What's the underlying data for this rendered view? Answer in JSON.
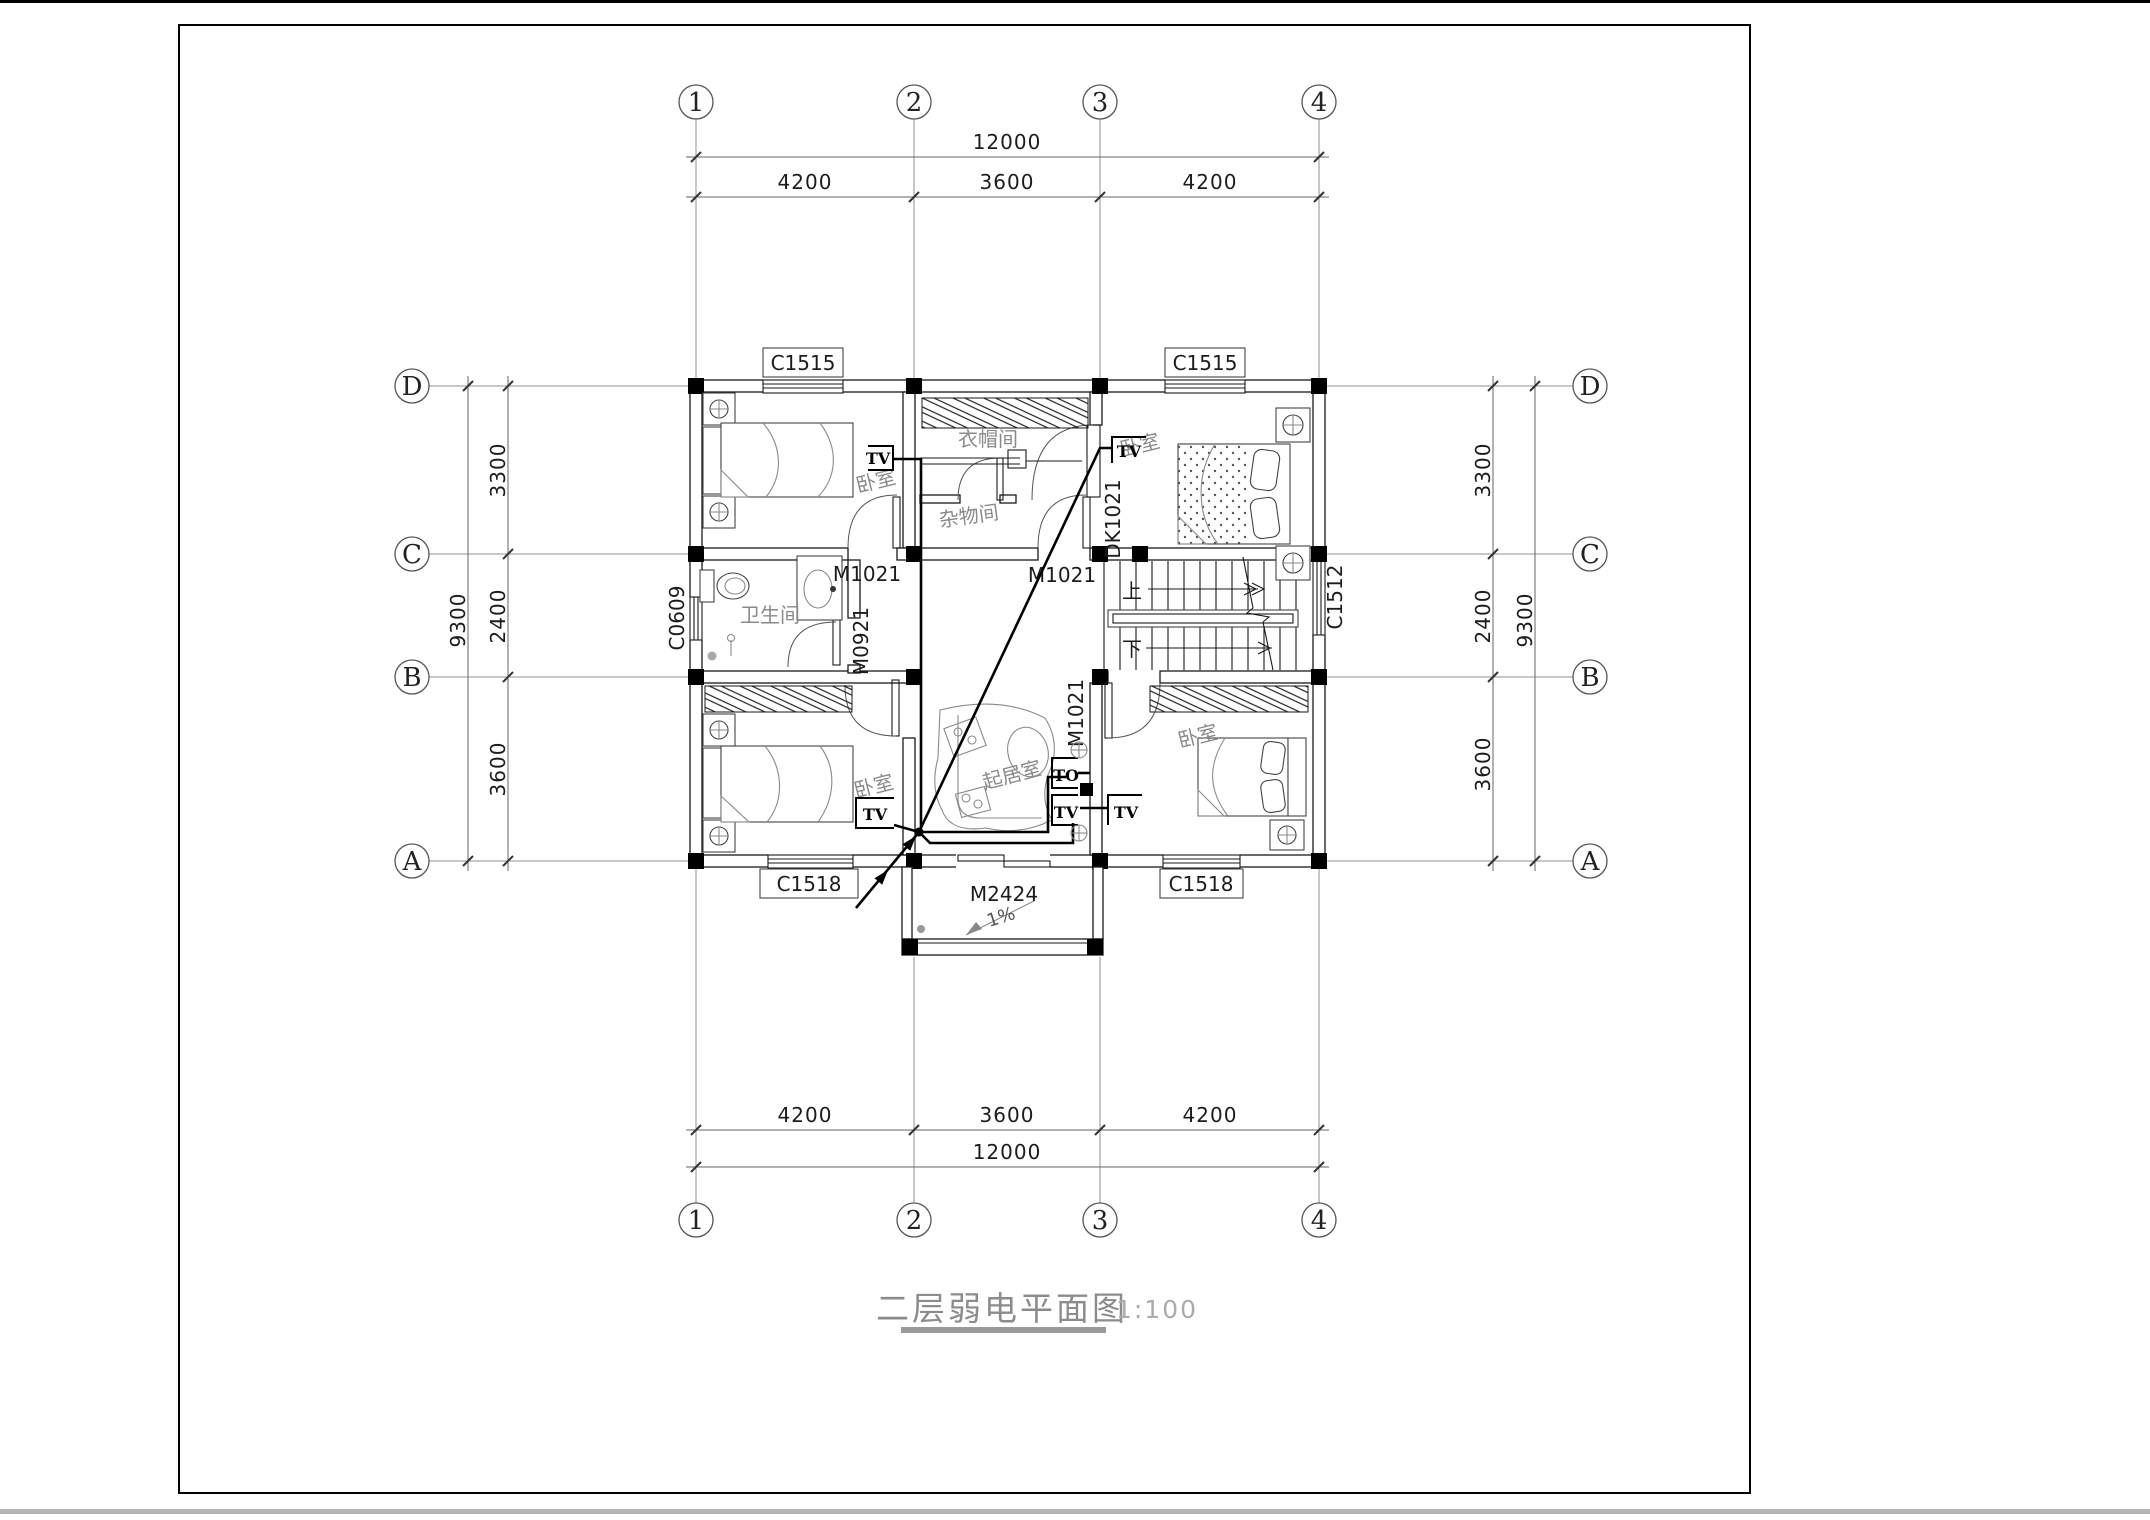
{
  "title": {
    "text": "二层弱电平面图",
    "scale": "1:100"
  },
  "grid": {
    "cols": [
      "1",
      "2",
      "3",
      "4"
    ],
    "rows": [
      "D",
      "C",
      "B",
      "A"
    ]
  },
  "dims": {
    "h_total": "12000",
    "h_segs": [
      "4200",
      "3600",
      "4200"
    ],
    "v_total": "9300",
    "v_segs": [
      "3300",
      "2400",
      "3600"
    ]
  },
  "windows": {
    "c1515": "C1515",
    "c1518": "C1518",
    "c0609": "C0609",
    "c1512": "C1512"
  },
  "doors": {
    "m1021": "M1021",
    "m0921": "M0921",
    "m2424": "M2424",
    "dk1021": "DK1021"
  },
  "rooms": {
    "bedroom": "卧室",
    "cloakroom": "衣帽间",
    "storage": "杂物间",
    "bathroom": "卫生间",
    "living": "起居室"
  },
  "outlets": {
    "tv": "TV",
    "to": "TO"
  },
  "stairs": {
    "up": "上",
    "down": "下"
  },
  "notes": {
    "slope": "1%"
  },
  "colors": {
    "line": "#000000",
    "grid": "#909090",
    "label": "#8a8a8a",
    "underline": "#9a9a9a"
  }
}
